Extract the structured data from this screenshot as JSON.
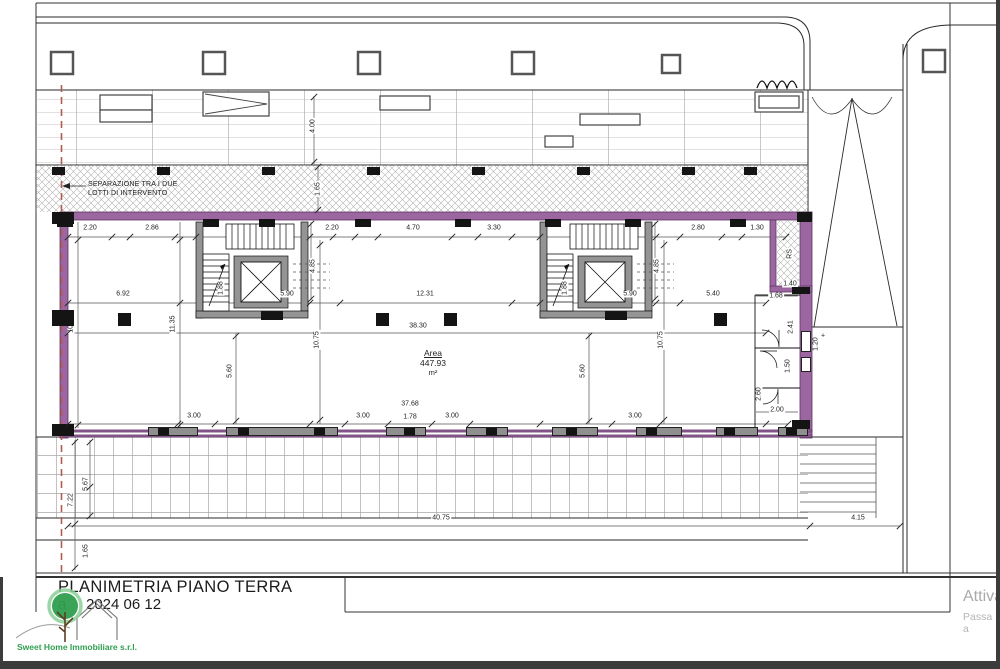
{
  "sheet": {
    "title": "PLANIMETRIA PIANO TERRA",
    "date_prefix": "a",
    "date": "2024 06 12"
  },
  "branding": {
    "company": "Sweet Home Immobiliare s.r.l."
  },
  "watermark": {
    "line1": "Attiva",
    "line2": "Passa a"
  },
  "plan": {
    "separation_note_line1": "SEPARAZIONE TRA I DUE",
    "separation_note_line2": "LOTTI DI INTERVENTO",
    "area_label": "Area",
    "area_value": "447.93",
    "area_unit": "m²",
    "colors": {
      "wall": "#9c67a0",
      "wall_dark": "#5e3364",
      "separation_line": "#b25b4e",
      "logo_green": "#2f9e4f"
    },
    "dim_labels": [
      {
        "t": "4.00",
        "x": 313,
        "y": 126,
        "r": 1
      },
      {
        "t": "1.65",
        "x": 318,
        "y": 189,
        "r": 1
      },
      {
        "t": "2.20",
        "x": 90,
        "y": 228
      },
      {
        "t": "2.86",
        "x": 152,
        "y": 228
      },
      {
        "t": "2.20",
        "x": 332,
        "y": 228
      },
      {
        "t": "4.70",
        "x": 413,
        "y": 228
      },
      {
        "t": "3.30",
        "x": 494,
        "y": 228
      },
      {
        "t": "2.80",
        "x": 698,
        "y": 228
      },
      {
        "t": "1.30",
        "x": 757,
        "y": 228
      },
      {
        "t": "6.92",
        "x": 123,
        "y": 294
      },
      {
        "t": "5.90",
        "x": 287,
        "y": 294
      },
      {
        "t": "12.31",
        "x": 425,
        "y": 294
      },
      {
        "t": "5.90",
        "x": 630,
        "y": 294
      },
      {
        "t": "5.40",
        "x": 713,
        "y": 294
      },
      {
        "t": "1.88",
        "x": 221,
        "y": 288,
        "r": 1
      },
      {
        "t": "4.85",
        "x": 313,
        "y": 266,
        "r": 1
      },
      {
        "t": "1.88",
        "x": 565,
        "y": 288,
        "r": 1
      },
      {
        "t": "4.85",
        "x": 657,
        "y": 266,
        "r": 1
      },
      {
        "t": "10.76",
        "x": 71,
        "y": 324,
        "r": 1
      },
      {
        "t": "11.35",
        "x": 173,
        "y": 324,
        "r": 1
      },
      {
        "t": "10.75",
        "x": 317,
        "y": 340,
        "r": 1
      },
      {
        "t": "10.75",
        "x": 661,
        "y": 340,
        "r": 1
      },
      {
        "t": "5.60",
        "x": 230,
        "y": 371,
        "r": 1
      },
      {
        "t": "5.60",
        "x": 583,
        "y": 371,
        "r": 1
      },
      {
        "t": "38.30",
        "x": 418,
        "y": 326
      },
      {
        "t": "37.68",
        "x": 410,
        "y": 404
      },
      {
        "t": "3.00",
        "x": 194,
        "y": 416
      },
      {
        "t": "3.00",
        "x": 363,
        "y": 416
      },
      {
        "t": "1.78",
        "x": 410,
        "y": 417
      },
      {
        "t": "3.00",
        "x": 452,
        "y": 416
      },
      {
        "t": "3.00",
        "x": 635,
        "y": 416
      },
      {
        "t": "1.68",
        "x": 776,
        "y": 296
      },
      {
        "t": "1.40",
        "x": 790,
        "y": 284
      },
      {
        "t": "2.41",
        "x": 791,
        "y": 327,
        "r": 1
      },
      {
        "t": "1.50",
        "x": 788,
        "y": 366,
        "r": 1
      },
      {
        "t": "1.20",
        "x": 816,
        "y": 344,
        "r": 1
      },
      {
        "t": "2.60",
        "x": 759,
        "y": 394,
        "r": 1
      },
      {
        "t": "2.00",
        "x": 777,
        "y": 410
      },
      {
        "t": "RS",
        "x": 790,
        "y": 254,
        "r": 1
      },
      {
        "t": "+",
        "x": 823,
        "y": 336
      },
      {
        "t": "7.22",
        "x": 71,
        "y": 500,
        "r": 1
      },
      {
        "t": "5.67",
        "x": 86,
        "y": 484,
        "r": 1
      },
      {
        "t": "1.65",
        "x": 86,
        "y": 551,
        "r": 1
      },
      {
        "t": "40.75",
        "x": 441,
        "y": 518
      },
      {
        "t": "4.15",
        "x": 858,
        "y": 518
      }
    ],
    "blocks": [
      {
        "x": 52,
        "y": 167,
        "w": 13,
        "h": 8,
        "c": "k"
      },
      {
        "x": 157,
        "y": 167,
        "w": 13,
        "h": 8,
        "c": "k"
      },
      {
        "x": 262,
        "y": 167,
        "w": 13,
        "h": 8,
        "c": "k"
      },
      {
        "x": 367,
        "y": 167,
        "w": 13,
        "h": 8,
        "c": "k"
      },
      {
        "x": 472,
        "y": 167,
        "w": 13,
        "h": 8,
        "c": "k"
      },
      {
        "x": 577,
        "y": 167,
        "w": 13,
        "h": 8,
        "c": "k"
      },
      {
        "x": 682,
        "y": 167,
        "w": 13,
        "h": 8,
        "c": "k"
      },
      {
        "x": 744,
        "y": 167,
        "w": 13,
        "h": 8,
        "c": "k"
      },
      {
        "x": 57,
        "y": 219,
        "w": 16,
        "h": 8,
        "c": "k"
      },
      {
        "x": 203,
        "y": 219,
        "w": 16,
        "h": 8,
        "c": "k"
      },
      {
        "x": 259,
        "y": 219,
        "w": 16,
        "h": 8,
        "c": "k"
      },
      {
        "x": 355,
        "y": 219,
        "w": 16,
        "h": 8,
        "c": "k"
      },
      {
        "x": 455,
        "y": 219,
        "w": 16,
        "h": 8,
        "c": "k"
      },
      {
        "x": 545,
        "y": 219,
        "w": 16,
        "h": 8,
        "c": "k"
      },
      {
        "x": 625,
        "y": 219,
        "w": 16,
        "h": 8,
        "c": "k"
      },
      {
        "x": 730,
        "y": 219,
        "w": 16,
        "h": 8,
        "c": "k"
      },
      {
        "x": 52,
        "y": 212,
        "w": 22,
        "h": 12,
        "c": "k"
      },
      {
        "x": 52,
        "y": 310,
        "w": 22,
        "h": 16,
        "c": "k"
      },
      {
        "x": 52,
        "y": 424,
        "w": 22,
        "h": 12,
        "c": "k"
      },
      {
        "x": 118,
        "y": 313,
        "w": 13,
        "h": 13,
        "c": "k"
      },
      {
        "x": 376,
        "y": 313,
        "w": 13,
        "h": 13,
        "c": "k"
      },
      {
        "x": 444,
        "y": 313,
        "w": 13,
        "h": 13,
        "c": "k"
      },
      {
        "x": 714,
        "y": 313,
        "w": 13,
        "h": 13,
        "c": "k"
      },
      {
        "x": 261,
        "y": 311,
        "w": 22,
        "h": 9,
        "c": "k"
      },
      {
        "x": 605,
        "y": 311,
        "w": 22,
        "h": 9,
        "c": "k"
      },
      {
        "x": 148,
        "y": 427,
        "w": 50,
        "h": 9,
        "c": "g"
      },
      {
        "x": 226,
        "y": 427,
        "w": 112,
        "h": 9,
        "c": "g"
      },
      {
        "x": 386,
        "y": 427,
        "w": 40,
        "h": 9,
        "c": "g"
      },
      {
        "x": 466,
        "y": 427,
        "w": 42,
        "h": 9,
        "c": "g"
      },
      {
        "x": 552,
        "y": 427,
        "w": 46,
        "h": 9,
        "c": "g"
      },
      {
        "x": 636,
        "y": 427,
        "w": 46,
        "h": 9,
        "c": "g"
      },
      {
        "x": 716,
        "y": 427,
        "w": 42,
        "h": 9,
        "c": "g"
      },
      {
        "x": 778,
        "y": 427,
        "w": 30,
        "h": 9,
        "c": "g"
      },
      {
        "x": 158,
        "y": 428,
        "w": 11,
        "h": 7,
        "c": "k"
      },
      {
        "x": 238,
        "y": 428,
        "w": 11,
        "h": 7,
        "c": "k"
      },
      {
        "x": 314,
        "y": 428,
        "w": 11,
        "h": 7,
        "c": "k"
      },
      {
        "x": 404,
        "y": 428,
        "w": 11,
        "h": 7,
        "c": "k"
      },
      {
        "x": 486,
        "y": 428,
        "w": 11,
        "h": 7,
        "c": "k"
      },
      {
        "x": 566,
        "y": 428,
        "w": 11,
        "h": 7,
        "c": "k"
      },
      {
        "x": 646,
        "y": 428,
        "w": 11,
        "h": 7,
        "c": "k"
      },
      {
        "x": 724,
        "y": 428,
        "w": 11,
        "h": 7,
        "c": "k"
      },
      {
        "x": 786,
        "y": 428,
        "w": 11,
        "h": 7,
        "c": "k"
      },
      {
        "x": 797,
        "y": 212,
        "w": 15,
        "h": 10,
        "c": "k"
      },
      {
        "x": 792,
        "y": 287,
        "w": 18,
        "h": 7,
        "c": "k"
      },
      {
        "x": 792,
        "y": 420,
        "w": 18,
        "h": 9,
        "c": "k"
      },
      {
        "x": 801,
        "y": 331,
        "w": 10,
        "h": 21,
        "c": "w"
      },
      {
        "x": 801,
        "y": 357,
        "w": 10,
        "h": 15,
        "c": "w"
      }
    ],
    "ticks": [
      {
        "x": 68,
        "y": 237
      },
      {
        "x": 112,
        "y": 237
      },
      {
        "x": 130,
        "y": 237
      },
      {
        "x": 175,
        "y": 237
      },
      {
        "x": 196,
        "y": 237
      },
      {
        "x": 310,
        "y": 237
      },
      {
        "x": 333,
        "y": 237
      },
      {
        "x": 355,
        "y": 237
      },
      {
        "x": 378,
        "y": 237
      },
      {
        "x": 452,
        "y": 237
      },
      {
        "x": 478,
        "y": 237
      },
      {
        "x": 512,
        "y": 237
      },
      {
        "x": 540,
        "y": 237
      },
      {
        "x": 656,
        "y": 237
      },
      {
        "x": 680,
        "y": 237
      },
      {
        "x": 722,
        "y": 237
      },
      {
        "x": 742,
        "y": 237
      },
      {
        "x": 786,
        "y": 237
      },
      {
        "x": 68,
        "y": 303
      },
      {
        "x": 180,
        "y": 303
      },
      {
        "x": 310,
        "y": 303
      },
      {
        "x": 340,
        "y": 303
      },
      {
        "x": 512,
        "y": 303
      },
      {
        "x": 540,
        "y": 303
      },
      {
        "x": 656,
        "y": 303
      },
      {
        "x": 680,
        "y": 303
      },
      {
        "x": 766,
        "y": 303
      },
      {
        "x": 68,
        "y": 333
      },
      {
        "x": 766,
        "y": 333
      },
      {
        "x": 68,
        "y": 424
      },
      {
        "x": 178,
        "y": 424
      },
      {
        "x": 215,
        "y": 424
      },
      {
        "x": 310,
        "y": 424
      },
      {
        "x": 345,
        "y": 424
      },
      {
        "x": 388,
        "y": 424
      },
      {
        "x": 432,
        "y": 424
      },
      {
        "x": 470,
        "y": 424
      },
      {
        "x": 540,
        "y": 424
      },
      {
        "x": 612,
        "y": 424
      },
      {
        "x": 660,
        "y": 424
      },
      {
        "x": 766,
        "y": 424
      },
      {
        "x": 788,
        "y": 424
      },
      {
        "x": 68,
        "y": 526
      },
      {
        "x": 810,
        "y": 526
      },
      {
        "x": 900,
        "y": 526
      },
      {
        "x": 78,
        "y": 240
      },
      {
        "x": 78,
        "y": 425
      },
      {
        "x": 180,
        "y": 240
      },
      {
        "x": 180,
        "y": 425
      },
      {
        "x": 320,
        "y": 245
      },
      {
        "x": 320,
        "y": 420
      },
      {
        "x": 664,
        "y": 245
      },
      {
        "x": 664,
        "y": 420
      },
      {
        "x": 311,
        "y": 224
      },
      {
        "x": 311,
        "y": 299
      },
      {
        "x": 655,
        "y": 224
      },
      {
        "x": 655,
        "y": 299
      },
      {
        "x": 236,
        "y": 336
      },
      {
        "x": 236,
        "y": 421
      },
      {
        "x": 589,
        "y": 336
      },
      {
        "x": 589,
        "y": 421
      },
      {
        "x": 75,
        "y": 442
      },
      {
        "x": 75,
        "y": 524
      },
      {
        "x": 75,
        "y": 568
      },
      {
        "x": 90,
        "y": 442
      },
      {
        "x": 90,
        "y": 487
      },
      {
        "x": 90,
        "y": 516
      },
      {
        "x": 314,
        "y": 97
      },
      {
        "x": 314,
        "y": 162
      },
      {
        "x": 318,
        "y": 167
      },
      {
        "x": 318,
        "y": 210
      }
    ]
  }
}
